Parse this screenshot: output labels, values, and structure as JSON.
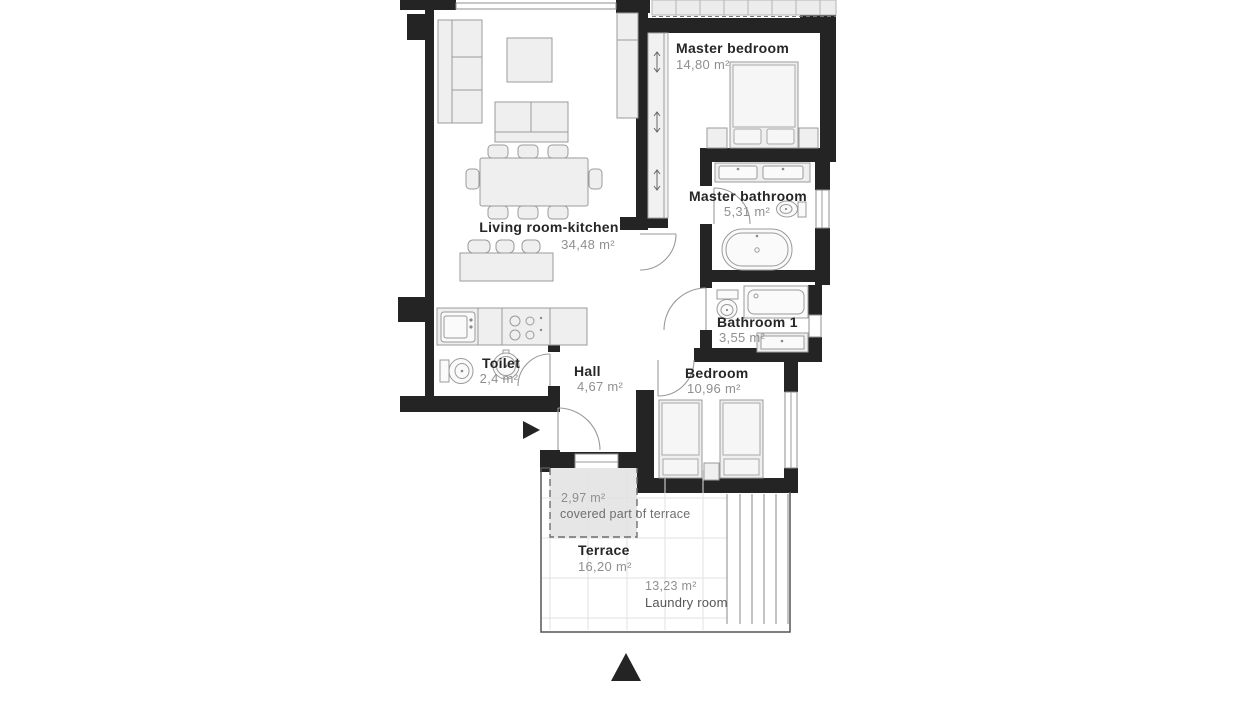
{
  "plan": {
    "title": "Apartment floor plan",
    "rooms": [
      {
        "id": "living-room-kitchen",
        "name": "Living room-kitchen",
        "area": "34,48 m²"
      },
      {
        "id": "master-bedroom",
        "name": "Master bedroom",
        "area": "14,80 m²"
      },
      {
        "id": "master-bathroom",
        "name": "Master bathroom",
        "area": "5,31 m²"
      },
      {
        "id": "bathroom-1",
        "name": "Bathroom 1",
        "area": "3,55 m²"
      },
      {
        "id": "bedroom",
        "name": "Bedroom",
        "area": "10,96 m²"
      },
      {
        "id": "hall",
        "name": "Hall",
        "area": "4,67 m²"
      },
      {
        "id": "toilet",
        "name": "Toilet",
        "area": "2,4 m²"
      },
      {
        "id": "terrace",
        "name": "Terrace",
        "area": "16,20 m²"
      }
    ],
    "annotations": [
      {
        "id": "covered-terrace",
        "area": "2,97 m²",
        "label": "covered part of terrace"
      },
      {
        "id": "laundry-room",
        "area": "13,23 m²",
        "label": "Laundry room"
      }
    ],
    "icons": {
      "north_arrow": "▲",
      "entrance_arrow": "►"
    },
    "colors": {
      "wall": "#242424",
      "furniture_fill": "#efefef",
      "furniture_stroke": "#9b9b9b",
      "name_text": "#262626",
      "area_text": "#8f8f8f",
      "covered_fill": "#e6e6e6"
    }
  }
}
